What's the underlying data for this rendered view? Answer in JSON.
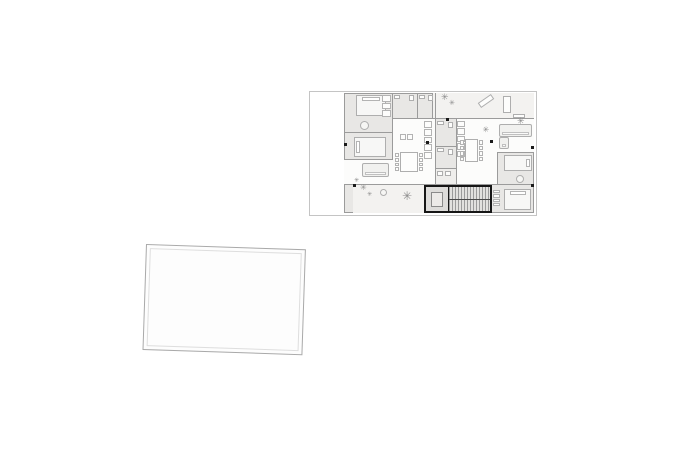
{
  "canvas": {
    "width": 690,
    "height": 457,
    "background": "#ffffff"
  },
  "colors": {
    "background": "#ffffff",
    "plan_boundary": "#c4c4c4",
    "wall": "#9b9b9b",
    "wall_dark": "#161616",
    "room_fill": "#e8e7e5",
    "terrace_fill": "#f3f2f0",
    "living_fill": "#fcfcfb",
    "furniture_line": "#aeaeae",
    "furniture_fill": "#f7f7f6",
    "stair_tread_bg": "#e2e1df",
    "plant": "#8c8c8c",
    "column": "#1a1a1a",
    "sheet_border": "#a9a9a9",
    "sheet_inner_border": "#dedede"
  },
  "floor_plan": {
    "x": 309,
    "y": 91,
    "width": 228,
    "height": 125,
    "plant_glyph": "✳",
    "items": [
      {
        "n": "building-body",
        "t": "region",
        "x": 34,
        "y": 1,
        "w": 190,
        "h": 120,
        "f": "#e8e7e5",
        "b": "#9b9b9b"
      },
      {
        "n": "upper-terrace",
        "t": "region",
        "x": 122,
        "y": 1,
        "w": 102,
        "h": 26,
        "f": "#f3f2f0"
      },
      {
        "n": "living-room-left",
        "t": "region",
        "x": 82,
        "y": 27,
        "w": 43,
        "h": 65,
        "f": "#fcfcfb"
      },
      {
        "n": "living-room-left-lower",
        "t": "region",
        "x": 34,
        "y": 68,
        "w": 48,
        "h": 24,
        "f": "#fcfcfb"
      },
      {
        "n": "living-room-right-upper",
        "t": "region",
        "x": 146,
        "y": 27,
        "w": 78,
        "h": 34,
        "f": "#fcfcfb"
      },
      {
        "n": "living-room-right-lower",
        "t": "region",
        "x": 146,
        "y": 61,
        "w": 41,
        "h": 31,
        "f": "#fcfcfb"
      },
      {
        "n": "lower-terrace",
        "t": "region",
        "x": 43,
        "y": 92,
        "w": 71,
        "h": 29,
        "f": "#f3f2f0"
      },
      {
        "n": "core-vestibule",
        "t": "region",
        "x": 125,
        "y": 77,
        "w": 21,
        "h": 15,
        "f": "#efeeec"
      },
      {
        "n": "wall-bedrooms-left",
        "t": "wall",
        "x": 82,
        "y": 1,
        "w": 1,
        "h": 67
      },
      {
        "n": "wall-bedroom-tl-bottom",
        "t": "wall",
        "x": 34,
        "y": 40,
        "w": 48,
        "h": 1
      },
      {
        "n": "wall-bedroom-l2-bottom",
        "t": "wall",
        "x": 34,
        "y": 67,
        "w": 48,
        "h": 1
      },
      {
        "n": "wall-top-band",
        "t": "wall",
        "x": 82,
        "y": 26,
        "w": 142,
        "h": 1
      },
      {
        "n": "wall-bath-divider-top",
        "t": "wall",
        "x": 107,
        "y": 1,
        "w": 1,
        "h": 25
      },
      {
        "n": "wall-core-left",
        "t": "wall",
        "x": 125,
        "y": 1,
        "w": 1,
        "h": 91
      },
      {
        "n": "wall-core-right",
        "t": "wall",
        "x": 146,
        "y": 27,
        "w": 1,
        "h": 65
      },
      {
        "n": "wall-core-div-1",
        "t": "wall",
        "x": 125,
        "y": 54,
        "w": 21,
        "h": 1
      },
      {
        "n": "wall-core-div-2",
        "t": "wall",
        "x": 125,
        "y": 76,
        "w": 21,
        "h": 1
      },
      {
        "n": "wall-main-bottom",
        "t": "wall",
        "x": 34,
        "y": 92,
        "w": 190,
        "h": 1
      },
      {
        "n": "wall-bedroom-rmid-top",
        "t": "wall",
        "x": 187,
        "y": 60,
        "w": 37,
        "h": 1
      },
      {
        "n": "wall-bedroom-rmid-left",
        "t": "wall",
        "x": 187,
        "y": 61,
        "w": 1,
        "h": 31
      },
      {
        "n": "wall-bedroom-rbottom-left",
        "t": "wall",
        "x": 181,
        "y": 93,
        "w": 1,
        "h": 28
      },
      {
        "n": "wall-terrace-left",
        "t": "wall",
        "x": 122,
        "y": 1,
        "w": 1,
        "h": 25
      },
      {
        "n": "bed-top-left",
        "t": "bed",
        "x": 46,
        "y": 3,
        "w": 30,
        "h": 21,
        "p": "t"
      },
      {
        "n": "bed-second-left",
        "t": "bed",
        "x": 44,
        "y": 45,
        "w": 32,
        "h": 20,
        "p": "l"
      },
      {
        "n": "bed-right-mid",
        "t": "bed",
        "x": 194,
        "y": 63,
        "w": 28,
        "h": 16,
        "p": "r"
      },
      {
        "n": "bed-right-bottom",
        "t": "bed",
        "x": 194,
        "y": 97,
        "w": 27,
        "h": 21,
        "p": "t"
      },
      {
        "n": "closet-top-left",
        "t": "row",
        "x": 72,
        "y": 3,
        "w": 9,
        "h": 22,
        "c": 3,
        "d": "v"
      },
      {
        "n": "wardrobe-right-bottom",
        "t": "row",
        "x": 183,
        "y": 98,
        "w": 7,
        "h": 16,
        "c": 4,
        "d": "v"
      },
      {
        "n": "kitchen-appliances-left",
        "t": "row",
        "x": 114,
        "y": 29,
        "w": 8,
        "h": 38,
        "c": 5,
        "d": "v"
      },
      {
        "n": "kitchen-appliances-right",
        "t": "row",
        "x": 147,
        "y": 29,
        "w": 8,
        "h": 36,
        "c": 5,
        "d": "v"
      },
      {
        "n": "sofa-left-unit",
        "t": "sofa",
        "x": 52,
        "y": 71,
        "w": 27,
        "h": 14
      },
      {
        "n": "sofa-right-unit",
        "t": "sofa",
        "x": 189,
        "y": 32,
        "w": 33,
        "h": 13
      },
      {
        "n": "sofa-right-chaise",
        "t": "sofa",
        "x": 189,
        "y": 45,
        "w": 10,
        "h": 12
      },
      {
        "n": "kitchen-island-left",
        "t": "row",
        "x": 90,
        "y": 42,
        "w": 13,
        "h": 6,
        "c": 2,
        "d": "h"
      },
      {
        "n": "dining-table-left",
        "t": "table",
        "x": 90,
        "y": 60,
        "w": 18,
        "h": 20
      },
      {
        "n": "dining-chairs-left-a",
        "t": "row",
        "x": 85,
        "y": 61,
        "w": 4,
        "h": 18,
        "c": 4,
        "d": "v"
      },
      {
        "n": "dining-chairs-left-b",
        "t": "row",
        "x": 109,
        "y": 61,
        "w": 4,
        "h": 18,
        "c": 4,
        "d": "v"
      },
      {
        "n": "dining-table-right",
        "t": "table",
        "x": 155,
        "y": 47,
        "w": 13,
        "h": 23
      },
      {
        "n": "dining-chairs-right-a",
        "t": "row",
        "x": 150,
        "y": 48,
        "w": 4,
        "h": 21,
        "c": 4,
        "d": "v"
      },
      {
        "n": "dining-chairs-right-b",
        "t": "row",
        "x": 169,
        "y": 48,
        "w": 4,
        "h": 21,
        "c": 4,
        "d": "v"
      },
      {
        "n": "bath1-sink",
        "t": "fix",
        "x": 84,
        "y": 3,
        "w": 6,
        "h": 4
      },
      {
        "n": "bath1-toilet",
        "t": "fix",
        "x": 99,
        "y": 3,
        "w": 5,
        "h": 6
      },
      {
        "n": "bath2-sink",
        "t": "fix",
        "x": 109,
        "y": 3,
        "w": 6,
        "h": 4
      },
      {
        "n": "bath2-toilet",
        "t": "fix",
        "x": 118,
        "y": 3,
        "w": 5,
        "h": 6
      },
      {
        "n": "core-bath1-sink",
        "t": "fix",
        "x": 127,
        "y": 29,
        "w": 7,
        "h": 4
      },
      {
        "n": "core-bath1-toilet",
        "t": "fix",
        "x": 138,
        "y": 30,
        "w": 5,
        "h": 6
      },
      {
        "n": "core-bath2-sink",
        "t": "fix",
        "x": 127,
        "y": 56,
        "w": 7,
        "h": 4
      },
      {
        "n": "core-bath2-toilet",
        "t": "fix",
        "x": 138,
        "y": 57,
        "w": 5,
        "h": 6
      },
      {
        "n": "laundry-unit-a",
        "t": "fix",
        "x": 127,
        "y": 79,
        "w": 6,
        "h": 5
      },
      {
        "n": "laundry-unit-b",
        "t": "fix",
        "x": 135,
        "y": 79,
        "w": 6,
        "h": 5
      },
      {
        "n": "terrace-lounge-diagonal",
        "t": "fix",
        "x": 168,
        "y": 6,
        "w": 16,
        "h": 6,
        "r": -35
      },
      {
        "n": "terrace-lounge-chair",
        "t": "fix",
        "x": 193,
        "y": 4,
        "w": 8,
        "h": 17
      },
      {
        "n": "terrace-cabinet",
        "t": "fix",
        "x": 203,
        "y": 22,
        "w": 12,
        "h": 4
      },
      {
        "n": "elevator",
        "t": "lift",
        "x": 114,
        "y": 93,
        "w": 26,
        "h": 28
      },
      {
        "n": "staircase",
        "t": "stairs",
        "x": 139,
        "y": 93,
        "w": 43,
        "h": 28
      },
      {
        "n": "column-left-wall",
        "t": "col",
        "x": 34,
        "y": 51
      },
      {
        "n": "column-terrace-corner",
        "t": "col",
        "x": 43,
        "y": 92
      },
      {
        "n": "column-kitchen-left",
        "t": "col",
        "x": 116,
        "y": 49
      },
      {
        "n": "column-living-right",
        "t": "col",
        "x": 180,
        "y": 48
      },
      {
        "n": "column-right-wall-upper",
        "t": "col",
        "x": 221,
        "y": 54
      },
      {
        "n": "column-right-wall-lower",
        "t": "col",
        "x": 221,
        "y": 92
      },
      {
        "n": "column-terrace-wall",
        "t": "col",
        "x": 136,
        "y": 26
      },
      {
        "n": "pot-plant-bedroom-tl",
        "t": "pot",
        "x": 50,
        "y": 29,
        "w": 9,
        "h": 9
      },
      {
        "n": "pot-plant-lower-terrace",
        "t": "pot",
        "x": 70,
        "y": 97,
        "w": 7,
        "h": 7
      },
      {
        "n": "pot-plant-bedroom-rmid",
        "t": "pot",
        "x": 206,
        "y": 83,
        "w": 8,
        "h": 8
      },
      {
        "n": "plant-upper-terrace-1",
        "t": "plant",
        "x": 131,
        "y": 2,
        "s": 9,
        "ch": "✳"
      },
      {
        "n": "plant-upper-terrace-2",
        "t": "plant",
        "x": 139,
        "y": 8,
        "s": 7,
        "ch": "✳"
      },
      {
        "n": "plant-right-corner",
        "t": "plant",
        "x": 207,
        "y": 26,
        "s": 9,
        "ch": "✳"
      },
      {
        "n": "plant-living-right",
        "t": "plant",
        "x": 173,
        "y": 34,
        "s": 8,
        "ch": "✳",
        "r": -40
      },
      {
        "n": "plant-lower-terrace-1",
        "t": "plant",
        "x": 50,
        "y": 92,
        "s": 8,
        "ch": "✳"
      },
      {
        "n": "plant-lower-terrace-2",
        "t": "plant",
        "x": 57,
        "y": 100,
        "s": 6,
        "ch": "✳"
      },
      {
        "n": "plant-lower-terrace-big",
        "t": "plant",
        "x": 92,
        "y": 98,
        "s": 12,
        "ch": "✳"
      },
      {
        "n": "plant-left-wall",
        "t": "plant",
        "x": 44,
        "y": 86,
        "s": 6,
        "ch": "✳"
      }
    ]
  },
  "blank_sheet": {
    "x": 146,
    "y": 244,
    "width": 160,
    "height": 106,
    "rotation_deg": 1.9
  }
}
